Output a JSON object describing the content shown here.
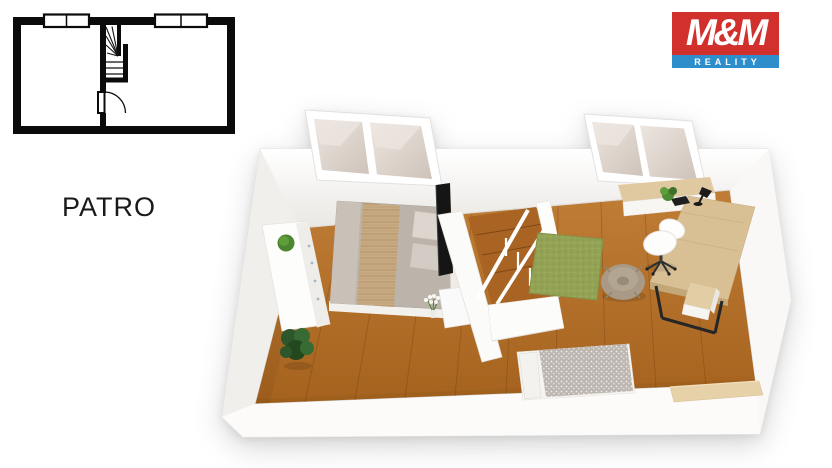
{
  "floor_label": "PATRO",
  "logo": {
    "top": "M&M",
    "bottom": "REALITY"
  },
  "colors": {
    "logo-red": "#d2302c",
    "logo-blue": "#2d8ecb",
    "plan-line": "#0b0b0b",
    "floor-wood": "#b4702b",
    "rug-green": "#93a254",
    "pouf-taupe": "#a89a86",
    "desk-wood": "#d9c094",
    "bench-wood": "#e6d1a8",
    "bed-gray": "#bcb3aa",
    "runner-tan": "#c9ab83",
    "blanket-gray": "#bdb6b0",
    "tv-black": "#151515",
    "plant-dark": "#2d572b",
    "plant-bright": "#5f9e3a",
    "wall-white": "#ffffff"
  },
  "plan_2d": {
    "elements": [
      "exterior-walls",
      "window-symbol-left",
      "window-symbol-right",
      "interior-wall",
      "winder-staircase",
      "door-with-swing-arc"
    ]
  },
  "plan_3d": {
    "rooms": [
      {
        "name": "bedroom",
        "furniture": [
          "skylight-window",
          "wardrobe-dresser",
          "dresser-plant",
          "double-bed",
          "bed-runner",
          "pillows",
          "tv-panel",
          "nightstand",
          "flower-vase",
          "floor-plant"
        ]
      },
      {
        "name": "study",
        "furniture": [
          "skylight-window",
          "staircase-with-railing",
          "sideboard",
          "desk",
          "desk-lamp",
          "laptop",
          "desk-plant",
          "office-chair",
          "area-rug",
          "pouf",
          "storage-box",
          "single-bed",
          "wall-bench"
        ]
      }
    ]
  }
}
